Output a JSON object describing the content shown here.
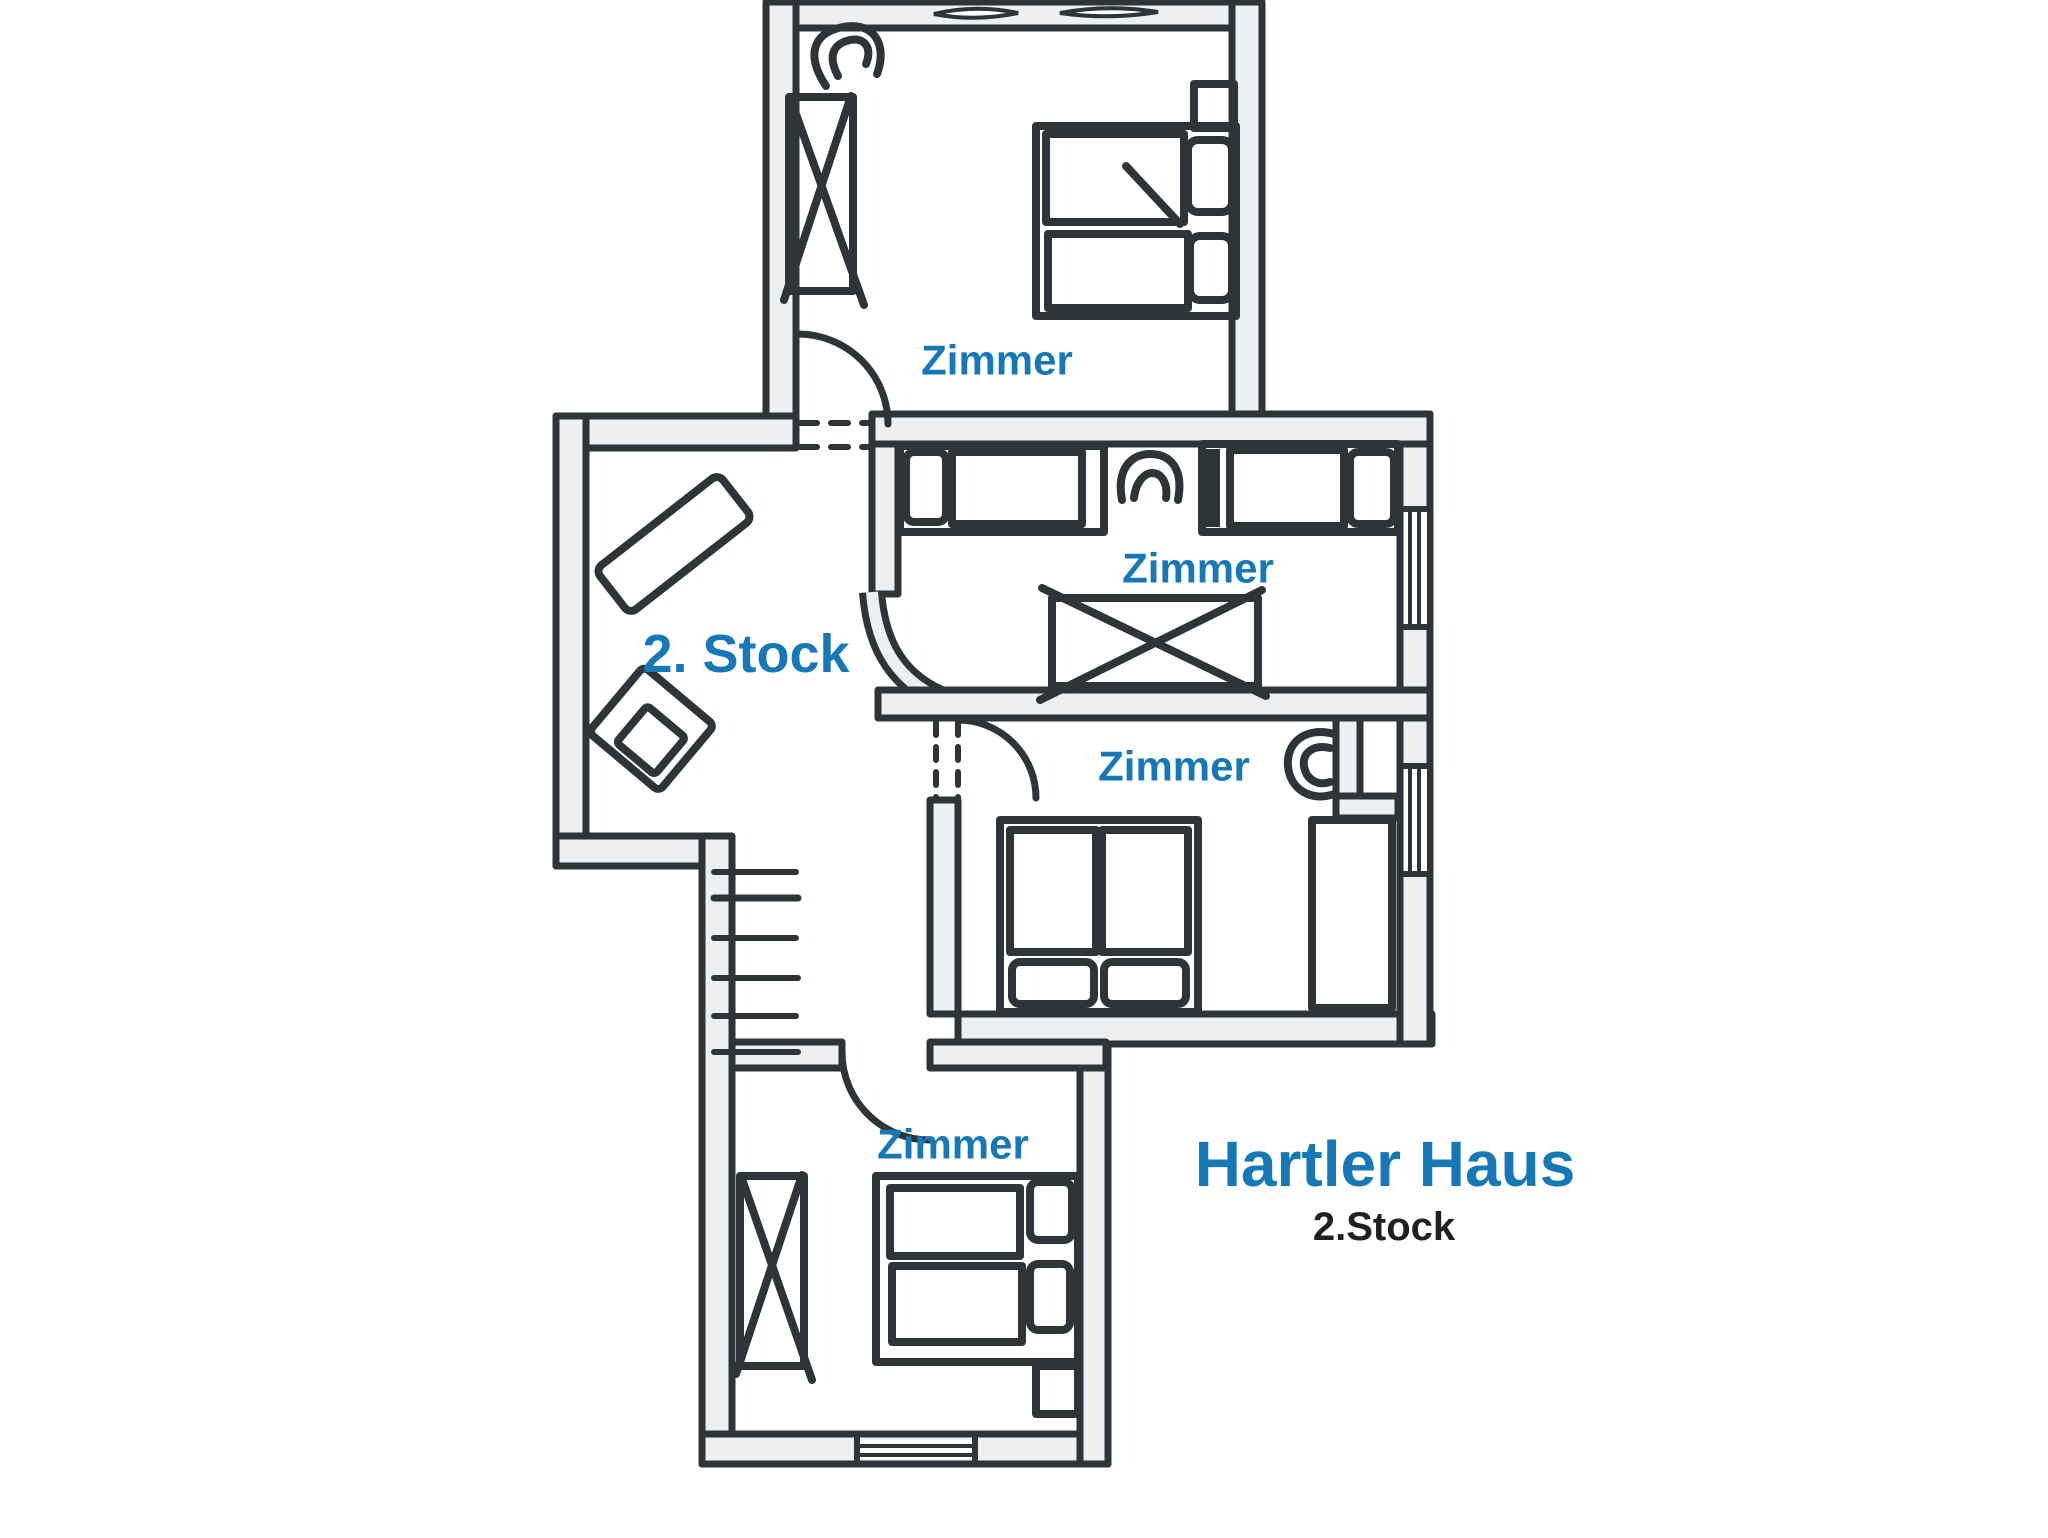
{
  "palette": {
    "ink": "#2f3438",
    "wall_fill": "#edeff1",
    "label_blue": "#1678b6",
    "subtitle_ink": "#1f2023",
    "background": "#ffffff"
  },
  "rooms": [
    {
      "name": "top-bedroom",
      "label": "Zimmer"
    },
    {
      "name": "middle-bedroom",
      "label": "Zimmer"
    },
    {
      "name": "lower-right-bedroom",
      "label": "Zimmer"
    },
    {
      "name": "bottom-bedroom",
      "label": "Zimmer"
    }
  ],
  "hall": {
    "label": "2. Stock"
  },
  "title": {
    "main": "Hartler Haus",
    "subtitle": "2.Stock"
  }
}
